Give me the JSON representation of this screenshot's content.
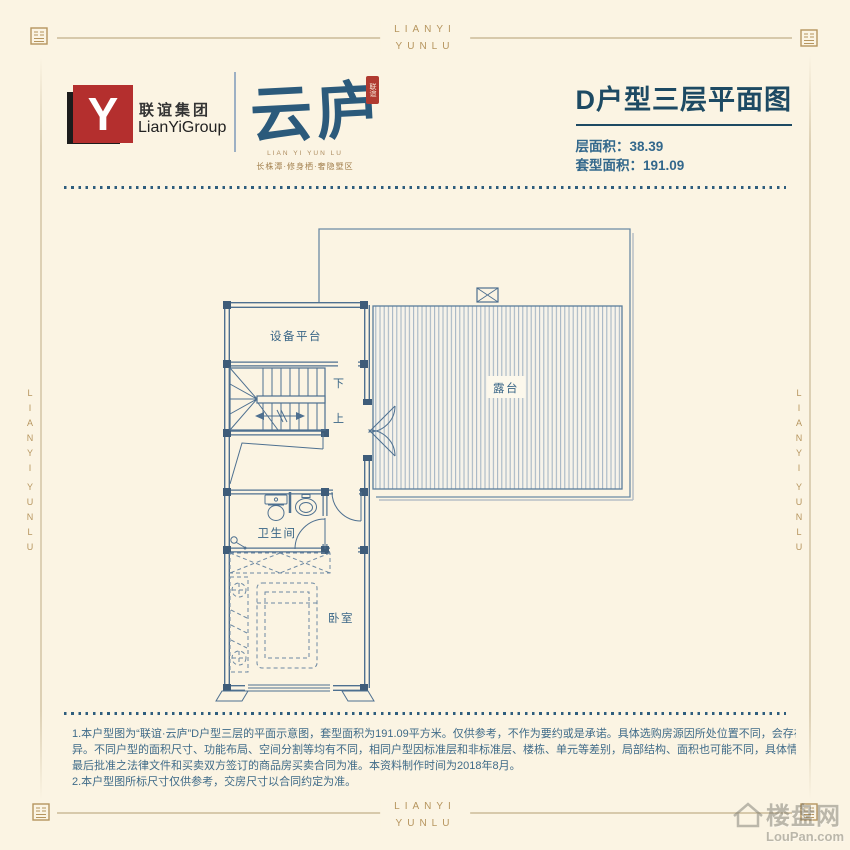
{
  "frame": {
    "brand": {
      "line1": "LIANYI",
      "line2": "YUNLU"
    },
    "accent_gold": "#b6955e"
  },
  "header": {
    "logo": {
      "monogram": "Y",
      "company_cn": "联谊集团",
      "company_en": "LianYiGroup",
      "brand_cn": "云庐",
      "seal_text": "联谊",
      "brand_en": "LIAN YI YUN LU",
      "tagline": "长株潭·修身栖·奢隐墅区",
      "brand_red": "#b42f2e",
      "brand_blue": "#2b5a7b"
    },
    "title": "D户型三层平面图",
    "stats": [
      {
        "label": "层面积：",
        "value": "38.39"
      },
      {
        "label": "套型面积：",
        "value": "191.09"
      }
    ]
  },
  "floorplan": {
    "line_color": "#4e7090",
    "rooms": {
      "equipment": "设备平台",
      "terrace": "露台",
      "bathroom": "卫生间",
      "bedroom": "卧室"
    },
    "stairs": {
      "down": "下",
      "up": "上"
    }
  },
  "disclaimer": {
    "lines": [
      "1.本户型图为“联谊·云庐”D户型三层的平面示意图，套型面积为191.09平方米。仅供参考，不作为要约或是承诺。具体选购房源因所处位置不同，会存在差",
      "异。不同户型的面积尺寸、功能布局、空间分割等均有不同，相同户型因标准层和非标准层、楼栋、单元等差别，局部结构、面积也可能不同，具体情况以政府",
      "最后批准之法律文件和买卖双方签订的商品房买卖合同为准。本资料制作时间为2018年8月。",
      "2.本户型图所标尺寸仅供参考，交房尺寸以合同约定为准。"
    ]
  },
  "watermark": {
    "cn": "楼盘网",
    "en": "LouPan.com"
  }
}
